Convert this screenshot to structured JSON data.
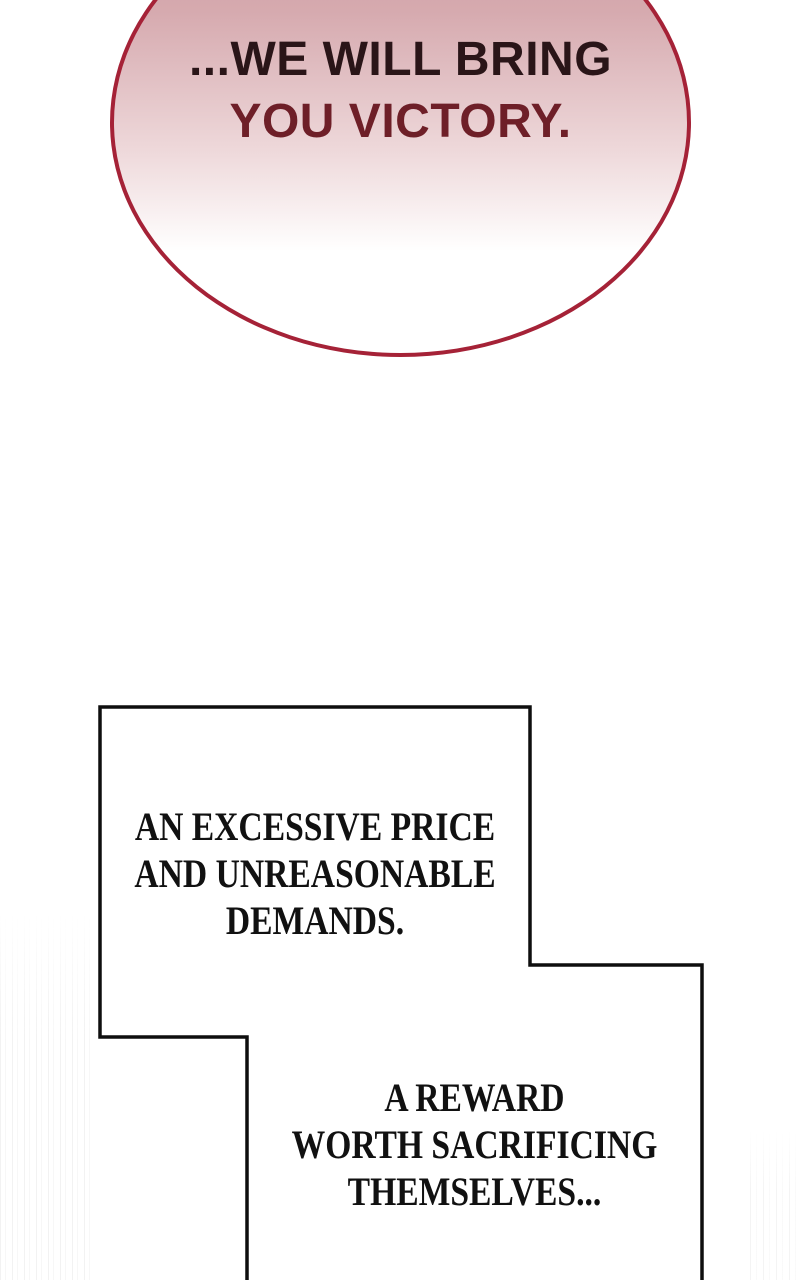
{
  "comic": {
    "speech_bubble": {
      "lines": [
        "...WE WILL BRING",
        "YOU VICTORY."
      ]
    },
    "captions": [
      {
        "lines": [
          "AN EXCESSIVE PRICE",
          "AND UNREASONABLE",
          "DEMANDS."
        ]
      },
      {
        "lines": [
          "A REWARD",
          "WORTH SACRIFICING",
          "THEMSELVES..."
        ]
      }
    ],
    "colors": {
      "page_bg": "#ffffff",
      "bubble_border": "#a52237",
      "bubble_gradient_top": "#cb9aa1",
      "bubble_gradient_mid": "#d6aaaf",
      "speech_line1": "#2a1518",
      "speech_line2": "#6e1f28",
      "panel_border": "#0e0e0e",
      "caption_text": "#111111"
    }
  }
}
